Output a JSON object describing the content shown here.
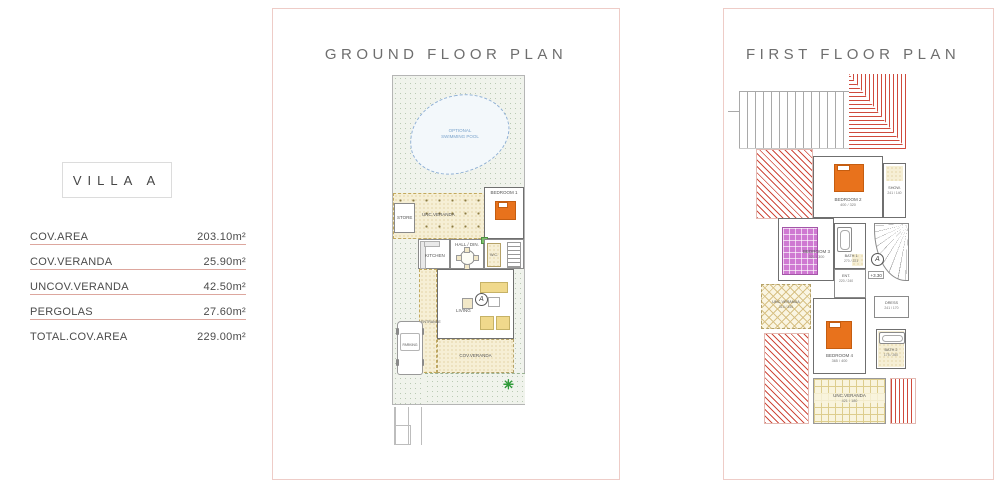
{
  "info_panel": {
    "title": "VILLA  A",
    "rows": [
      {
        "label": "COV.AREA",
        "value": "203.10m²"
      },
      {
        "label": "COV.VERANDA",
        "value": "25.90m²"
      },
      {
        "label": "UNCOV.VERANDA",
        "value": "42.50m²"
      },
      {
        "label": "PERGOLAS",
        "value": "27.60m²"
      },
      {
        "label": "TOTAL.COV.AREA",
        "value": "229.00m²"
      }
    ]
  },
  "ground_floor": {
    "title": "GROUND FLOOR PLAN",
    "pool_label": "OPTIONAL SWIMMING POOL",
    "rooms": {
      "store": {
        "label": "STORE"
      },
      "pergola": {
        "label": "UNC.VERANDA"
      },
      "bedroom1": {
        "label": "BEDROOM 1"
      },
      "kitchen": {
        "label": "KITCHEN"
      },
      "hall": {
        "label": "HALL / DIN."
      },
      "wc": {
        "label": "W.C."
      },
      "living": {
        "label": "LIVING"
      },
      "entrance": {
        "label": "ENTRANCE"
      },
      "parking": {
        "label": "PARKING"
      },
      "cov_veranda": {
        "label": "COV.VERANDA"
      }
    },
    "section_marker": "A"
  },
  "first_floor": {
    "title": "FIRST FLOOR PLAN",
    "rooms": {
      "bedroom2": {
        "label": "BEDROOM 2",
        "dim": "400 / 320"
      },
      "shower": {
        "label": "SHOW.",
        "dim": "241 / 140"
      },
      "bedroom3": {
        "label": "BEDROOM 3",
        "dim": "321 / 300"
      },
      "bath1": {
        "label": "BATH 1",
        "dim": "270 / 221"
      },
      "ent": {
        "label": "ENT.",
        "dim": "220 / 240"
      },
      "dress": {
        "label": "DRESS",
        "dim": "241 / 170"
      },
      "bedroom4": {
        "label": "BEDROOM 4",
        "dim": "365 / 400"
      },
      "bath2": {
        "label": "BATH 2",
        "dim": "175 / 260"
      },
      "unc_veranda_left": {
        "label": "UNC.VERANDA",
        "dim": "310 / 345"
      },
      "unc_veranda_bottom": {
        "label": "UNC.VERANDA",
        "dim": "421 / 180"
      }
    },
    "level_marker": "+3.30",
    "section_marker": "A"
  },
  "icons": {
    "palm": "✳"
  },
  "colors": {
    "panel_border": "#eeccc7",
    "underline_red": "#dda79e",
    "roof_hatch_red": "#cf4a3c",
    "bed_orange": "#e8721c",
    "bed_purple": "#cf79d2",
    "hatch_yellow": "#d3bd7e",
    "garden_green": "#b9c9b3",
    "pool_blue": "#8fb0d6",
    "wall_gray": "#6f6f6f",
    "title_gray": "#6e6e6e"
  }
}
